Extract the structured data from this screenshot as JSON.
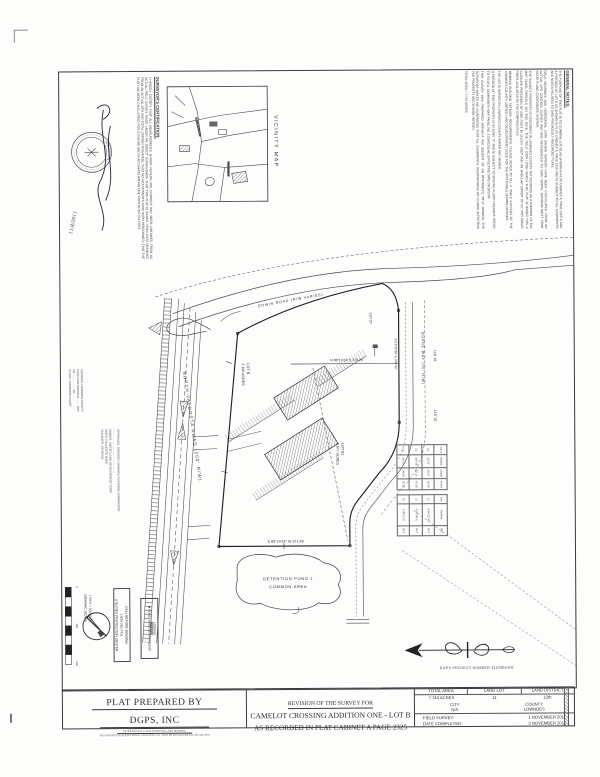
{
  "document": {
    "project_number": "DGPS PROJECT NUMBER  11103BURH",
    "prepared_by": {
      "title": "PLAT PREPARED BY",
      "company": "DGPS, INC",
      "profession": "PROFESSIONAL LAND SURVEYING AND MAPPING",
      "address": "3835 KNIGHTS ACADEMY ROAD,  VALDOSTA, GA.  31605   PH 229-745-0588    FAX 229-245-0601"
    },
    "title": {
      "revision_line": "REVISION OF THE SURVEY FOR",
      "name_line": "CAMELOT CROSSING ADDITION ONE - LOT B",
      "recorded_line": "AS RECORDED IN PLAT CABINET A PAGE 2325"
    },
    "info_table": {
      "total_area_header": "TOTAL  AREA",
      "land_lot_header": "LAND  LOT",
      "land_district_header": "LAND  DISTRICT",
      "total_area_value": "7.743  ACRES",
      "land_lot_value": "11",
      "land_district_value": "12th",
      "city_header": "CITY",
      "county_header": "COUNTY",
      "city_value": "N/A",
      "county_value": "LOWNDES",
      "field_survey_label": "FIELD SURVEY:",
      "field_survey_value": "1 NOVEMBER 2011",
      "date_completed_label": "DATE COMPLETED:",
      "date_completed_value": "3 NOVEMBER 2011"
    }
  },
  "general_notes": {
    "heading": "GENERAL NOTES:",
    "p1": "THE PURPOSE OF THIS PLAT IS TO COMBINE LOT B1 AS SHOWN IN PLAT CABINET A, PAGE 2325-C AND A PORTION OF LOT B AS SHOWN IN PLAT CABINET A, PAGE 2325 AND IS SUBJECT TO ALL EASEMENTS AND NOTES RELATED TO SAID PREVIOUSLY RECORDED PLATS.",
    "p2": "FIELD BEARINGS AND HORIZONTAL DATA SHOWN HEREON HAVE BEEN CALCULATED FROM AN ACTUAL GPS CONTROL SURVEY AND ARE REFERENCED TO GRID NORTH, GEORGIA WEST ZONE STATE PLANE COORDINATE SYSTEM.",
    "p3": "THE SUBJECT PROPERTY IS DESCRIBED IN LOWNDES COUNTY TAX RECORDS AS A PORTION OF TAX MAP 0116B, PARCELS 183 AND 250-B. THE FIELD DATA UPON WHICH THIS PLAT IS BASED HAS A CLOSURE PRECISION OF ONE FOOT IN 15,000+ FEET AND AN ANGULAR ERROR OF 02\" PER ANGLE POINT, ADJUSTED BY THE COMPASS RULE.",
    "p4": "MINIMUM BUILDING SETBACK REQUIREMENTS: PLEASE REFER TO CH. 4, TABLE 4.03.02(C) OF THE LOWNDES COUNTY UNIFIED LAND DEVELOPMENT CODE FOR THE APPLICABLE ZONING DISTRICT.",
    "p5": "THE LOT IS SERVED BY LOWNDES COUNTY WATER AND SEWER.",
    "p6": "A PORTION OF THIS PROPERTY IS IN ZONE \"X\" AND IS SUBJECT TO SPECIAL FLOOD HAZARDS. REFER TO F.E.M.A. COMMUNITY MAP PANEL NO. 13185C0114E, EFFECTIVE DATE 09/26/2008.",
    "p7": "THIS SURVEY WAS PREPARED WITHOUT THE BENEFIT OF AN ATTORNEY'S TITLE OPINION. THE SURVEYOR MAKES NO GUARANTEE THAT ALL EASEMENTS, RESTRICTIONS OR CLAIMS AFFECTING THE PROPERTY ARE SHOWN HEREON.",
    "p8": "TOTAL AREA = 7.743 ACRES"
  },
  "certification": {
    "heading": "SURVEYOR'S CERTIFICATION:",
    "body": "I HEREBY CERTIFY THAT ALL MEASUREMENTS SHOWN HEREON ARE CORRECT AND WERE OBTAINED FROM AN ACTUAL FIELD SURVEY MADE UNDER MY DIRECT SUPERVISION; THAT THIS PLAT IS BASED UPON DATA OBTAINED FROM AN ACTUAL GPS AND TOTAL STATION TRAVERSE; THAT NO ADJUSTMENTS HAVE BEEN PERFORMED; THAT THE PLAT HAS BEEN CALCULATED FOR CLOSURE AND IS ACCURATE WITHIN ONE FOOT IN 857,511 FEET.",
    "seal_arc_text": "GEORGIA",
    "seal_date": "11/4/2011"
  },
  "vicinity": {
    "label": "VICINITY MAP",
    "road1": "N. VALDOSTA RD",
    "road2": "WINDEMERE"
  },
  "margin": {
    "recording": "GEORGIA, LOWNDES COUNTY\nFILED FOR RECORD ........ DAY\nOF .................. 20......\nCLERK, SUPERIOR COURT",
    "owner": "APPROVED:  GREATER LOWNDES PLANNING COMMISSION\n.......................................................\nOWNER:  UNITED LAND DEVELOPMENT CORP\nNORTH VALDOSTA ROAD\nVALDOSTA, GEORGIA"
  },
  "plat": {
    "road_nv": "NORTH  VALDOSTA  ROAD    (200'  R/W)",
    "road_edwin": "EDWIN  ROAD    (R/W  VARIES)",
    "road_burne": "BURNE  WAY    (50'  R/W)",
    "lot_left_name": "LOT B",
    "lot_left_area": "3.180 ACRES",
    "lot_right_name": "LOT B1",
    "lot_right_area": "3.877 ACRES",
    "lot25": "LOT 25",
    "lot26": "LOT 26",
    "lot27": "LOT 27",
    "pond_line1": "DETENTION  POND  1",
    "pond_line2": "COMMON  AREA",
    "bearing_south": "S 88°14'24\" W    371.46'",
    "bearing_mid": "N 88°14'24\" E    370.26'",
    "bearing_east": "S 01°45'36\" E    232.02'",
    "curve_table": {
      "c0": "Curve",
      "c1": "Radius",
      "c2": "Length",
      "c3": "Chord",
      "rows": [
        [
          "C1",
          "25.00'",
          "39.27'",
          "35.36'"
        ],
        [
          "C2",
          "329.04'",
          "82.11'",
          "81.93'"
        ],
        [
          "C3",
          "25.00'",
          "38.94'",
          "35.12'"
        ]
      ]
    },
    "line_table": {
      "c0": "Line",
      "c1": "Bearing",
      "c2": "Dist",
      "rows": [
        [
          "L1",
          "N 46°12' W",
          "35.2'"
        ],
        [
          "L2",
          "N 43°48' E",
          "50.0'"
        ],
        [
          "L3",
          "S 46°12' E",
          "35.2'"
        ]
      ]
    }
  },
  "scale_bar": {
    "caption": "GRAPHIC SCALE",
    "sub": "1 INCH = 100 FEET",
    "t0": "0",
    "t1": "100",
    "t2": "200"
  },
  "call_box": {
    "l1": "CALL BEFORE DIGGING",
    "l2": "1-800-282-7411",
    "l3": "UTILITIES PROTECTION CENTER"
  },
  "legend": {
    "heading": "LEGEND",
    "item": "■  CONC. MONUMENT FOUND"
  }
}
